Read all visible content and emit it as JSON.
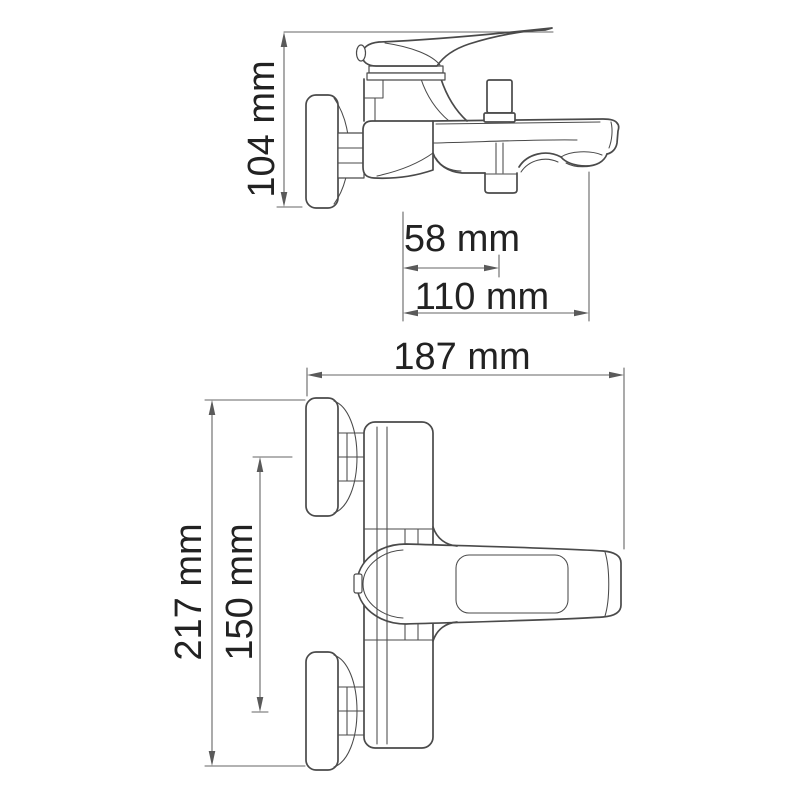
{
  "canvas": {
    "background_color": "#ffffff",
    "outline_color": "#4a4a4a",
    "dimension_line_color": "#666666",
    "text_color": "#222222"
  },
  "drawing": {
    "subject": "Wall-mounted single-lever bath mixer faucet, dimensional technical drawing with two orthographic views",
    "views": [
      {
        "id": "side-elevation",
        "description": "side view of faucet with handle, diverter knob and spout",
        "dimensions": [
          {
            "id": "overall-height",
            "label": "104 mm",
            "value_mm": 104,
            "orientation": "vertical"
          },
          {
            "id": "outlet-offset",
            "label": "58 mm",
            "value_mm": 58,
            "orientation": "horizontal"
          },
          {
            "id": "spout-reach",
            "label": "110 mm",
            "value_mm": 110,
            "orientation": "horizontal"
          }
        ]
      },
      {
        "id": "plan-view",
        "description": "top view of faucet with two wall escutcheons and lever handle",
        "dimensions": [
          {
            "id": "overall-depth",
            "label": "187 mm",
            "value_mm": 187,
            "orientation": "horizontal"
          },
          {
            "id": "overall-width",
            "label": "217 mm",
            "value_mm": 217,
            "orientation": "vertical"
          },
          {
            "id": "connection-spacing",
            "label": "150 mm",
            "value_mm": 150,
            "orientation": "vertical"
          }
        ]
      }
    ]
  }
}
